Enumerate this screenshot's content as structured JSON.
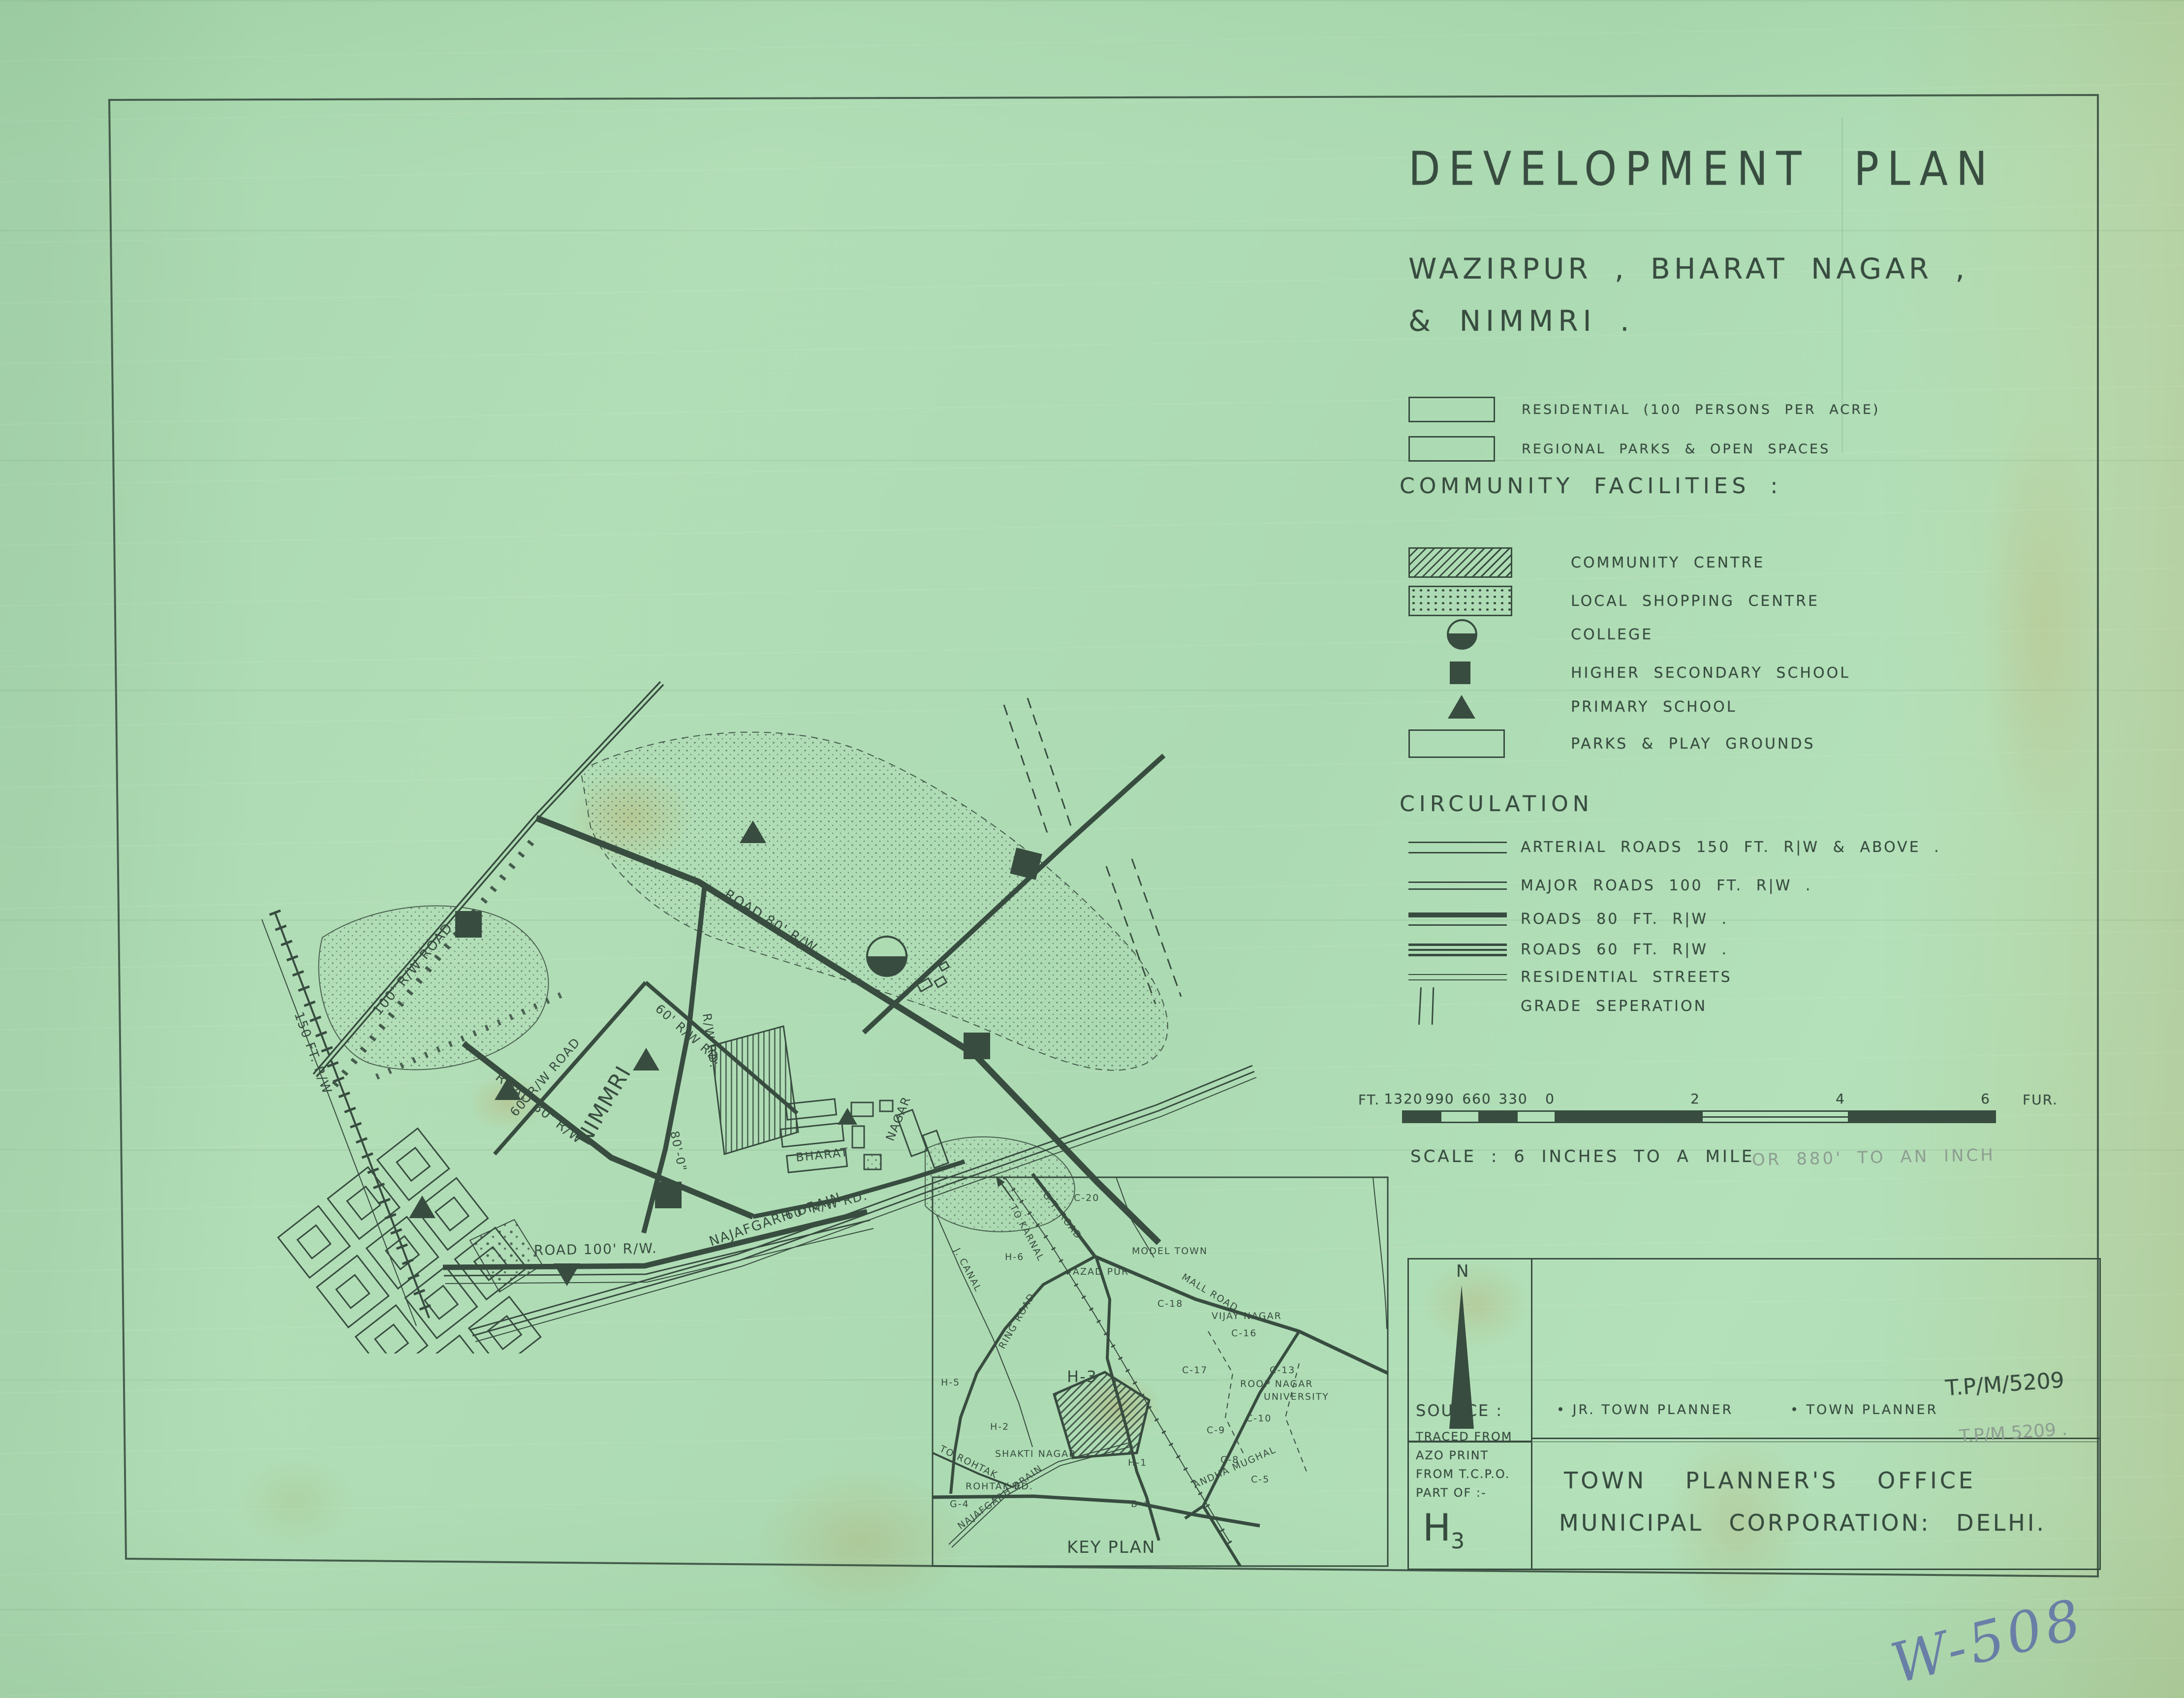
{
  "colors": {
    "paper": "#a9d9ae",
    "ink": "#2d4336",
    "pencil": "#87998b",
    "blue_pen": "#5565a8",
    "stain": "#b98e3e"
  },
  "title": {
    "line1": "DEVELOPMENT PLAN",
    "line2": "WAZIRPUR , BHARAT NAGAR ,",
    "line3": "& NIMMRI ."
  },
  "legend": {
    "residential_label": "RESIDENTIAL (100 PERSONS PER ACRE)",
    "regional_label": "REGIONAL PARKS & OPEN SPACES",
    "community_heading": "COMMUNITY FACILITIES :",
    "facilities": [
      {
        "label": "COMMUNITY CENTRE"
      },
      {
        "label": "LOCAL SHOPPING CENTRE"
      },
      {
        "label": "COLLEGE"
      },
      {
        "label": "HIGHER SECONDARY SCHOOL"
      },
      {
        "label": "PRIMARY SCHOOL"
      },
      {
        "label": "PARKS & PLAY GROUNDS"
      }
    ],
    "circulation_heading": "CIRCULATION",
    "circulation": [
      {
        "label": "ARTERIAL ROADS 150 FT. R|W & ABOVE ."
      },
      {
        "label": "MAJOR ROADS 100 FT. R|W ."
      },
      {
        "label": "ROADS 80 FT. R|W ."
      },
      {
        "label": "ROADS 60 FT. R|W ."
      },
      {
        "label": "RESIDENTIAL STREETS"
      },
      {
        "label": "GRADE SEPERATION"
      }
    ]
  },
  "scale": {
    "unit_left": "FT.",
    "ticks_left": [
      "1320",
      "990",
      "660",
      "330",
      "0"
    ],
    "ticks_right": [
      "2",
      "4",
      "6"
    ],
    "unit_right": "FUR.",
    "caption": "SCALE : 6 INCHES TO A MILE",
    "caption_pencil": "OR 880' TO AN INCH"
  },
  "map": {
    "labels": {
      "l_100rw": "100' R/W ROAD",
      "l_80top": "ROAD 80' R/W",
      "l_rail": "150 FT. R/W",
      "l_60road": "60' R/W ROAD",
      "l_60rd": "60' R/W RD.",
      "l_rwrd": "R/W RD.",
      "l_80v": "80'-0\"",
      "l_nimmri": "NIMMRI",
      "l_80mid": "ROAD 80' R/W",
      "l_60rd2": "60' R/W RD.",
      "l_100b": "ROAD 100' R/W.",
      "l_drain": "NAJAFGARH DRAIN",
      "l_bharat": "BHARAT",
      "l_nagar": "NAGAR"
    }
  },
  "key_plan": {
    "caption": "KEY PLAN",
    "labels": [
      "C-20",
      "G.T. ROAD",
      "TO KARNAL",
      "J. CANAL",
      "H-6",
      "RING ROAD",
      "AZAD PUR",
      "MODEL TOWN",
      "MALL ROAD",
      "C-18",
      "VIJAY NAGAR",
      "C-16",
      "H-5",
      "H-3",
      "C-17",
      "C-13",
      "ROOP NAGAR",
      "UNIVERSITY",
      "C-10",
      "H-2",
      "C-9",
      "SHAKTI NAGAR",
      "H-1",
      "C-8",
      "C-5",
      "TO ROHTAK",
      "ROHTAK RD.",
      "G-4",
      "NAJAFGARH DRAIN",
      "ANDHA MUGHAL",
      "B-4"
    ]
  },
  "title_block": {
    "north": "N",
    "source": "SOURCE :",
    "source_lines": [
      "TRACED FROM",
      "AZO PRINT",
      "FROM T.C.P.O.",
      "PART OF :-"
    ],
    "sheet": "H",
    "sheet_sub": "3",
    "signatories": [
      "• JR. TOWN PLANNER",
      "• TOWN PLANNER"
    ],
    "ref": "T.P/M/5209",
    "ref_pencil": "T.P/M 5209 .",
    "office1": "TOWN PLANNER'S OFFICE",
    "office2": "MUNICIPAL CORPORATION: DELHI."
  },
  "annotations": {
    "blue": "W-508"
  }
}
